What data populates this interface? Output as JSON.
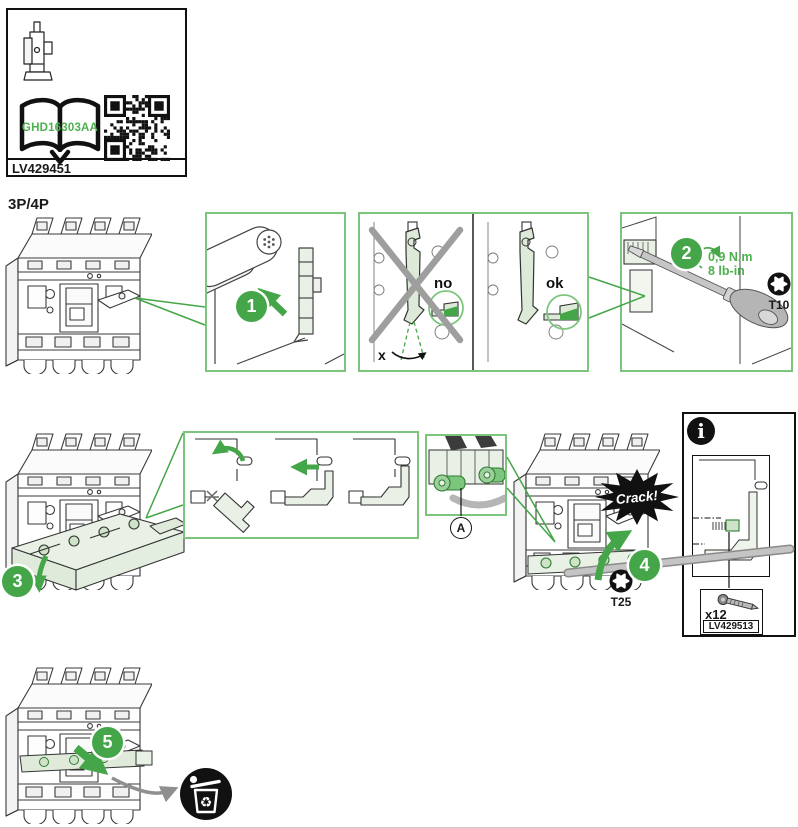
{
  "document": {
    "label_box": {
      "doc_ref": "GHD16303AA",
      "part_number": "LV429451"
    },
    "pole_heading": "3P/4P"
  },
  "steps": [
    {
      "number": "1"
    },
    {
      "number": "2",
      "torque_metric": "0,9 N.m",
      "torque_imperial": "8 lb-in",
      "bit_size": "T10"
    },
    {
      "number": "3"
    },
    {
      "number": "4",
      "sound_effect": "Crack!",
      "bit_size": "T25"
    },
    {
      "number": "5"
    }
  ],
  "alignment_check": {
    "wrong_label": "no",
    "right_label": "ok",
    "angle_label": "x"
  },
  "detail_callout": {
    "label": "A"
  },
  "info_panel": {
    "icon_glyph": "i",
    "screw_quantity": "x12",
    "kit_reference": "LV429513"
  },
  "colors": {
    "accent_green": "#44a648",
    "panel_border_green": "#7cc57c",
    "light_green_fill": "#e9f1e6",
    "ink": "#1a1a1a"
  }
}
